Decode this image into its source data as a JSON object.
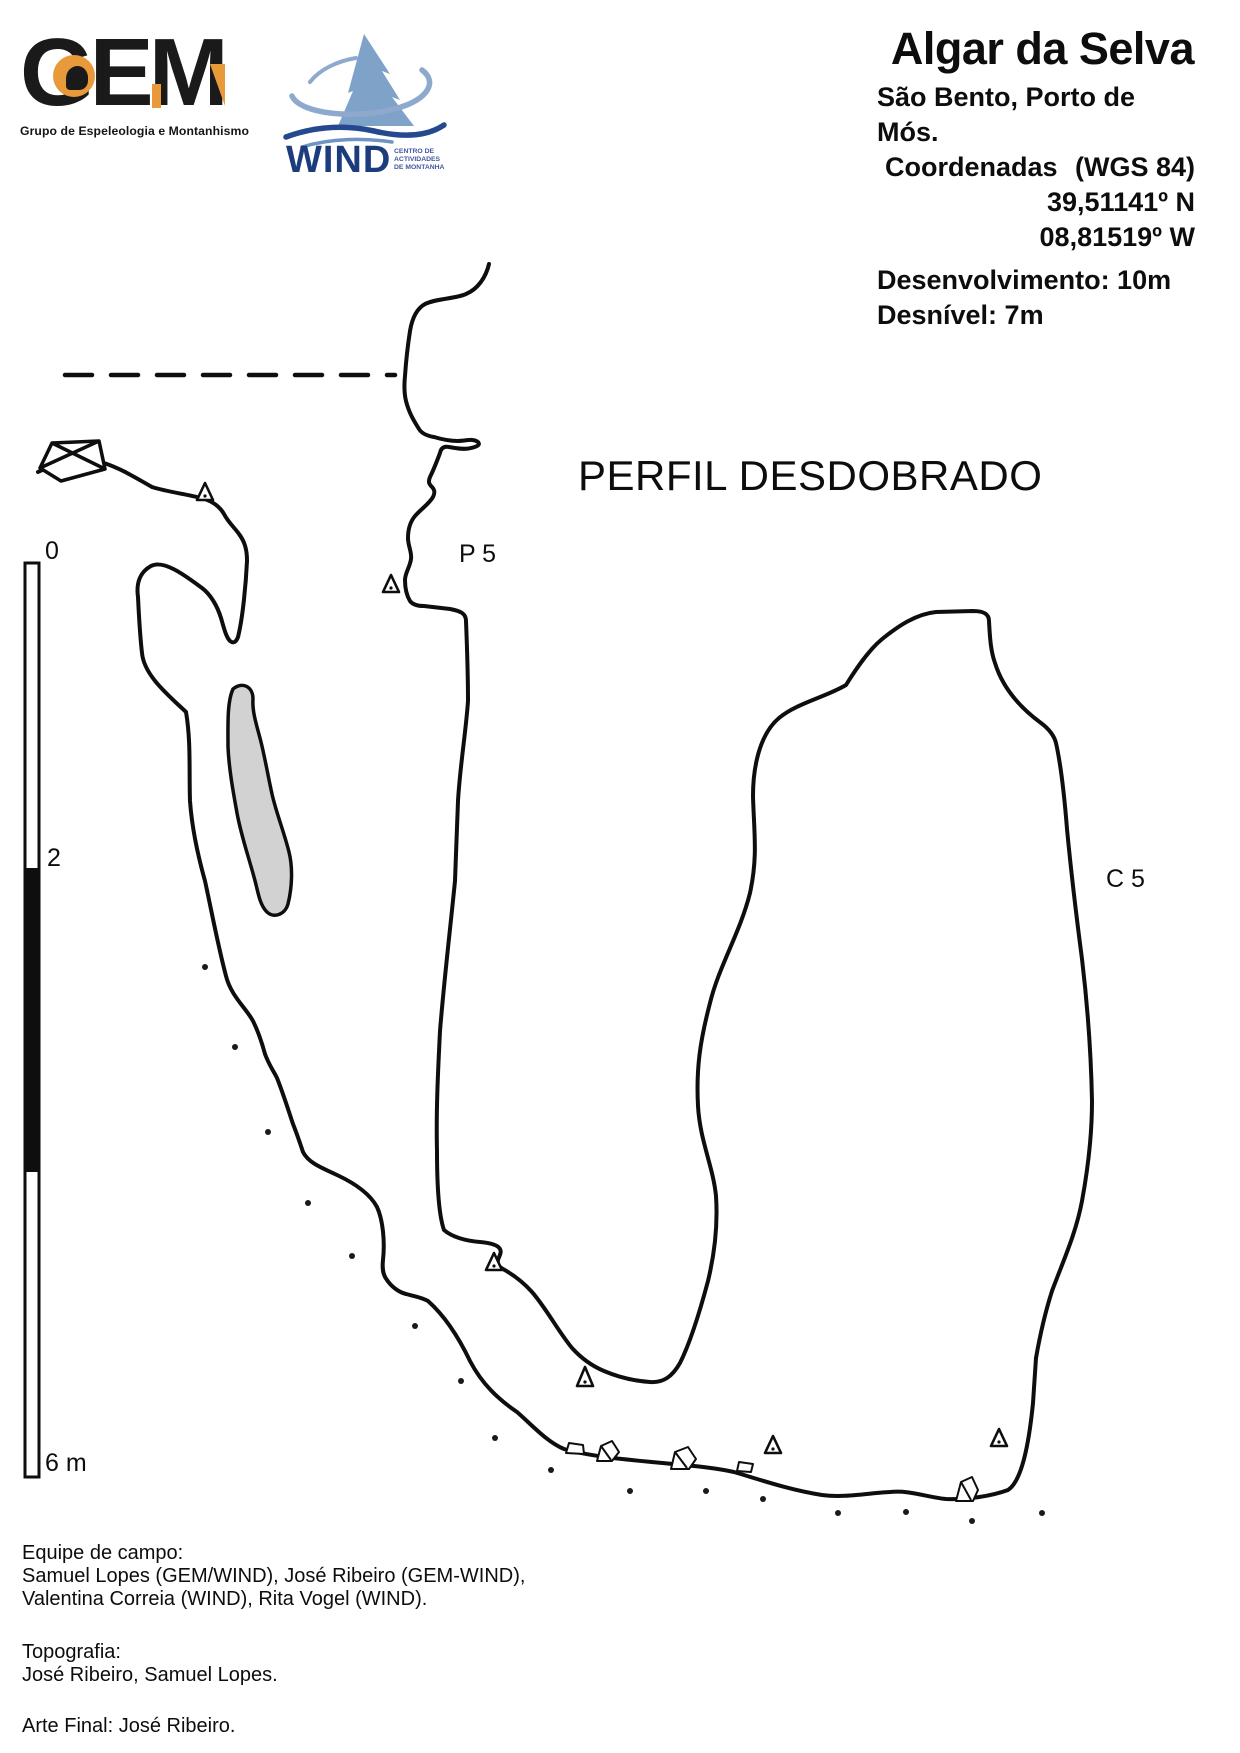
{
  "colors": {
    "ink": "#111111",
    "gem_accent": "#E89A3B",
    "wind_navy": "#1D3C7C",
    "wind_blue": "#7FA2C8",
    "pocket_gray": "#D2D2D2"
  },
  "gem_logo": {
    "acronym": "GEM",
    "tagline": "Grupo de Espeleologia e Montanhismo"
  },
  "wind_logo": {
    "name": "WIND",
    "subtitle_line1": "CENTRO DE",
    "subtitle_line2": "ACTIVIDADES",
    "subtitle_line3": "DE MONTANHA"
  },
  "header": {
    "title": "Algar da Selva",
    "location": "São Bento, Porto de Mós.",
    "coordinates_label": "Coordenadas",
    "datum": "(WGS 84)",
    "latitude": "39,51141º N",
    "longitude": "08,81519º W",
    "development": "Desenvolvimento: 10m",
    "depth": "Desnível: 7m"
  },
  "drawing": {
    "view_label": "PERFIL DESDOBRADO",
    "station_p5": "P 5",
    "station_c5": "C 5"
  },
  "scale_bar": {
    "label_0": "0",
    "label_2": "2",
    "label_6": "6 m"
  },
  "credits": {
    "team_label": "Equipe de campo:",
    "team_line1": "Samuel Lopes (GEM/WIND), José Ribeiro (GEM-WIND),",
    "team_line2": "Valentina Correia (WIND), Rita Vogel (WIND).",
    "topography_label": "Topografia:",
    "topography_names": "José Ribeiro, Samuel Lopes.",
    "final_art": "Arte Final: José Ribeiro."
  }
}
